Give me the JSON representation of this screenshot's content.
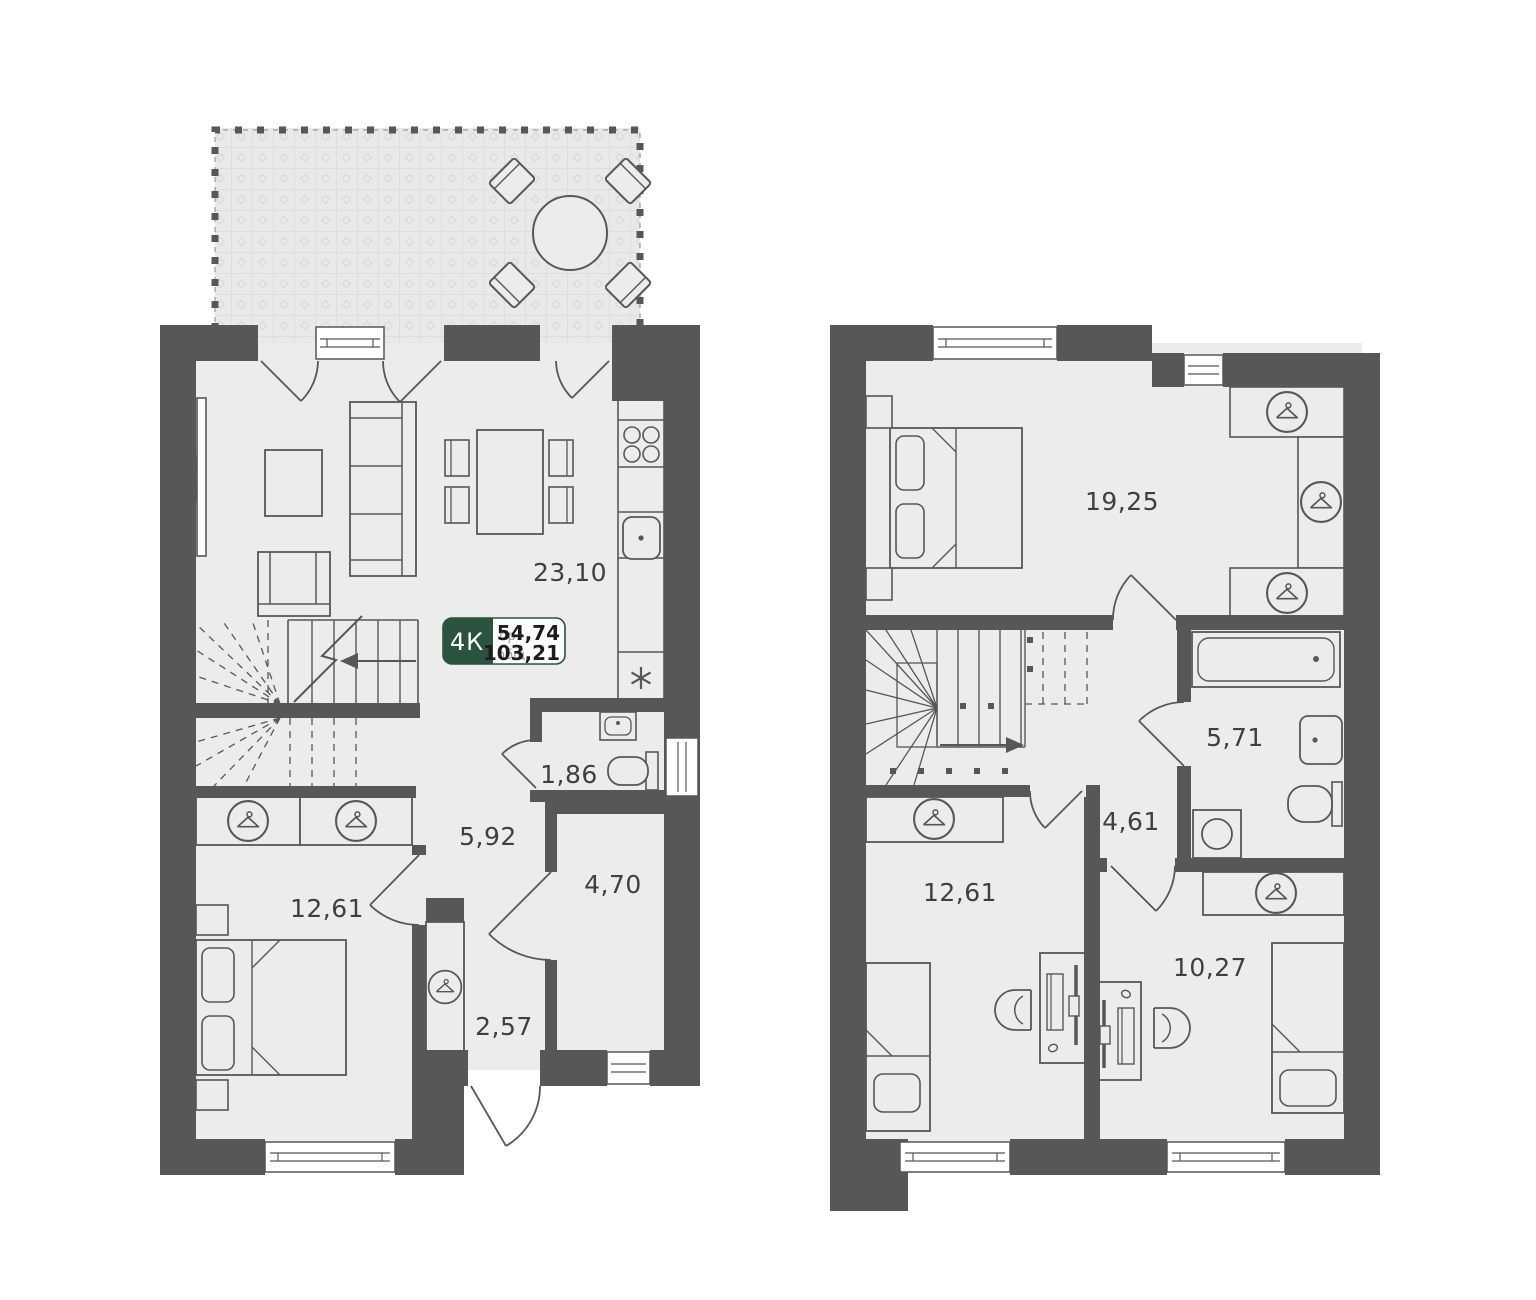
{
  "badge": {
    "rooms": "4К",
    "projected_label": "пр.",
    "projected_area": "54,74",
    "total_label": "общ.",
    "total_area": "103,21"
  },
  "floor1": {
    "living_kitchen": "23,10",
    "wc": "1,86",
    "hall": "5,92",
    "storage": "4,70",
    "entry": "2,57",
    "bedroom": "12,61"
  },
  "floor2": {
    "bedroom_main": "19,25",
    "bathroom": "5,71",
    "hall": "4,61",
    "bedroom_second": "12,61",
    "bedroom_third": "10,27"
  },
  "colors": {
    "wall": "#575756",
    "floor": "#ececec",
    "terrace_tile": "#e9e9e8",
    "label": "#3f3f3e",
    "badge_green": "#2b5340",
    "badge_number": "#1d1d1b",
    "badge_label_gray": "#9b9b9a",
    "white": "#ffffff"
  }
}
